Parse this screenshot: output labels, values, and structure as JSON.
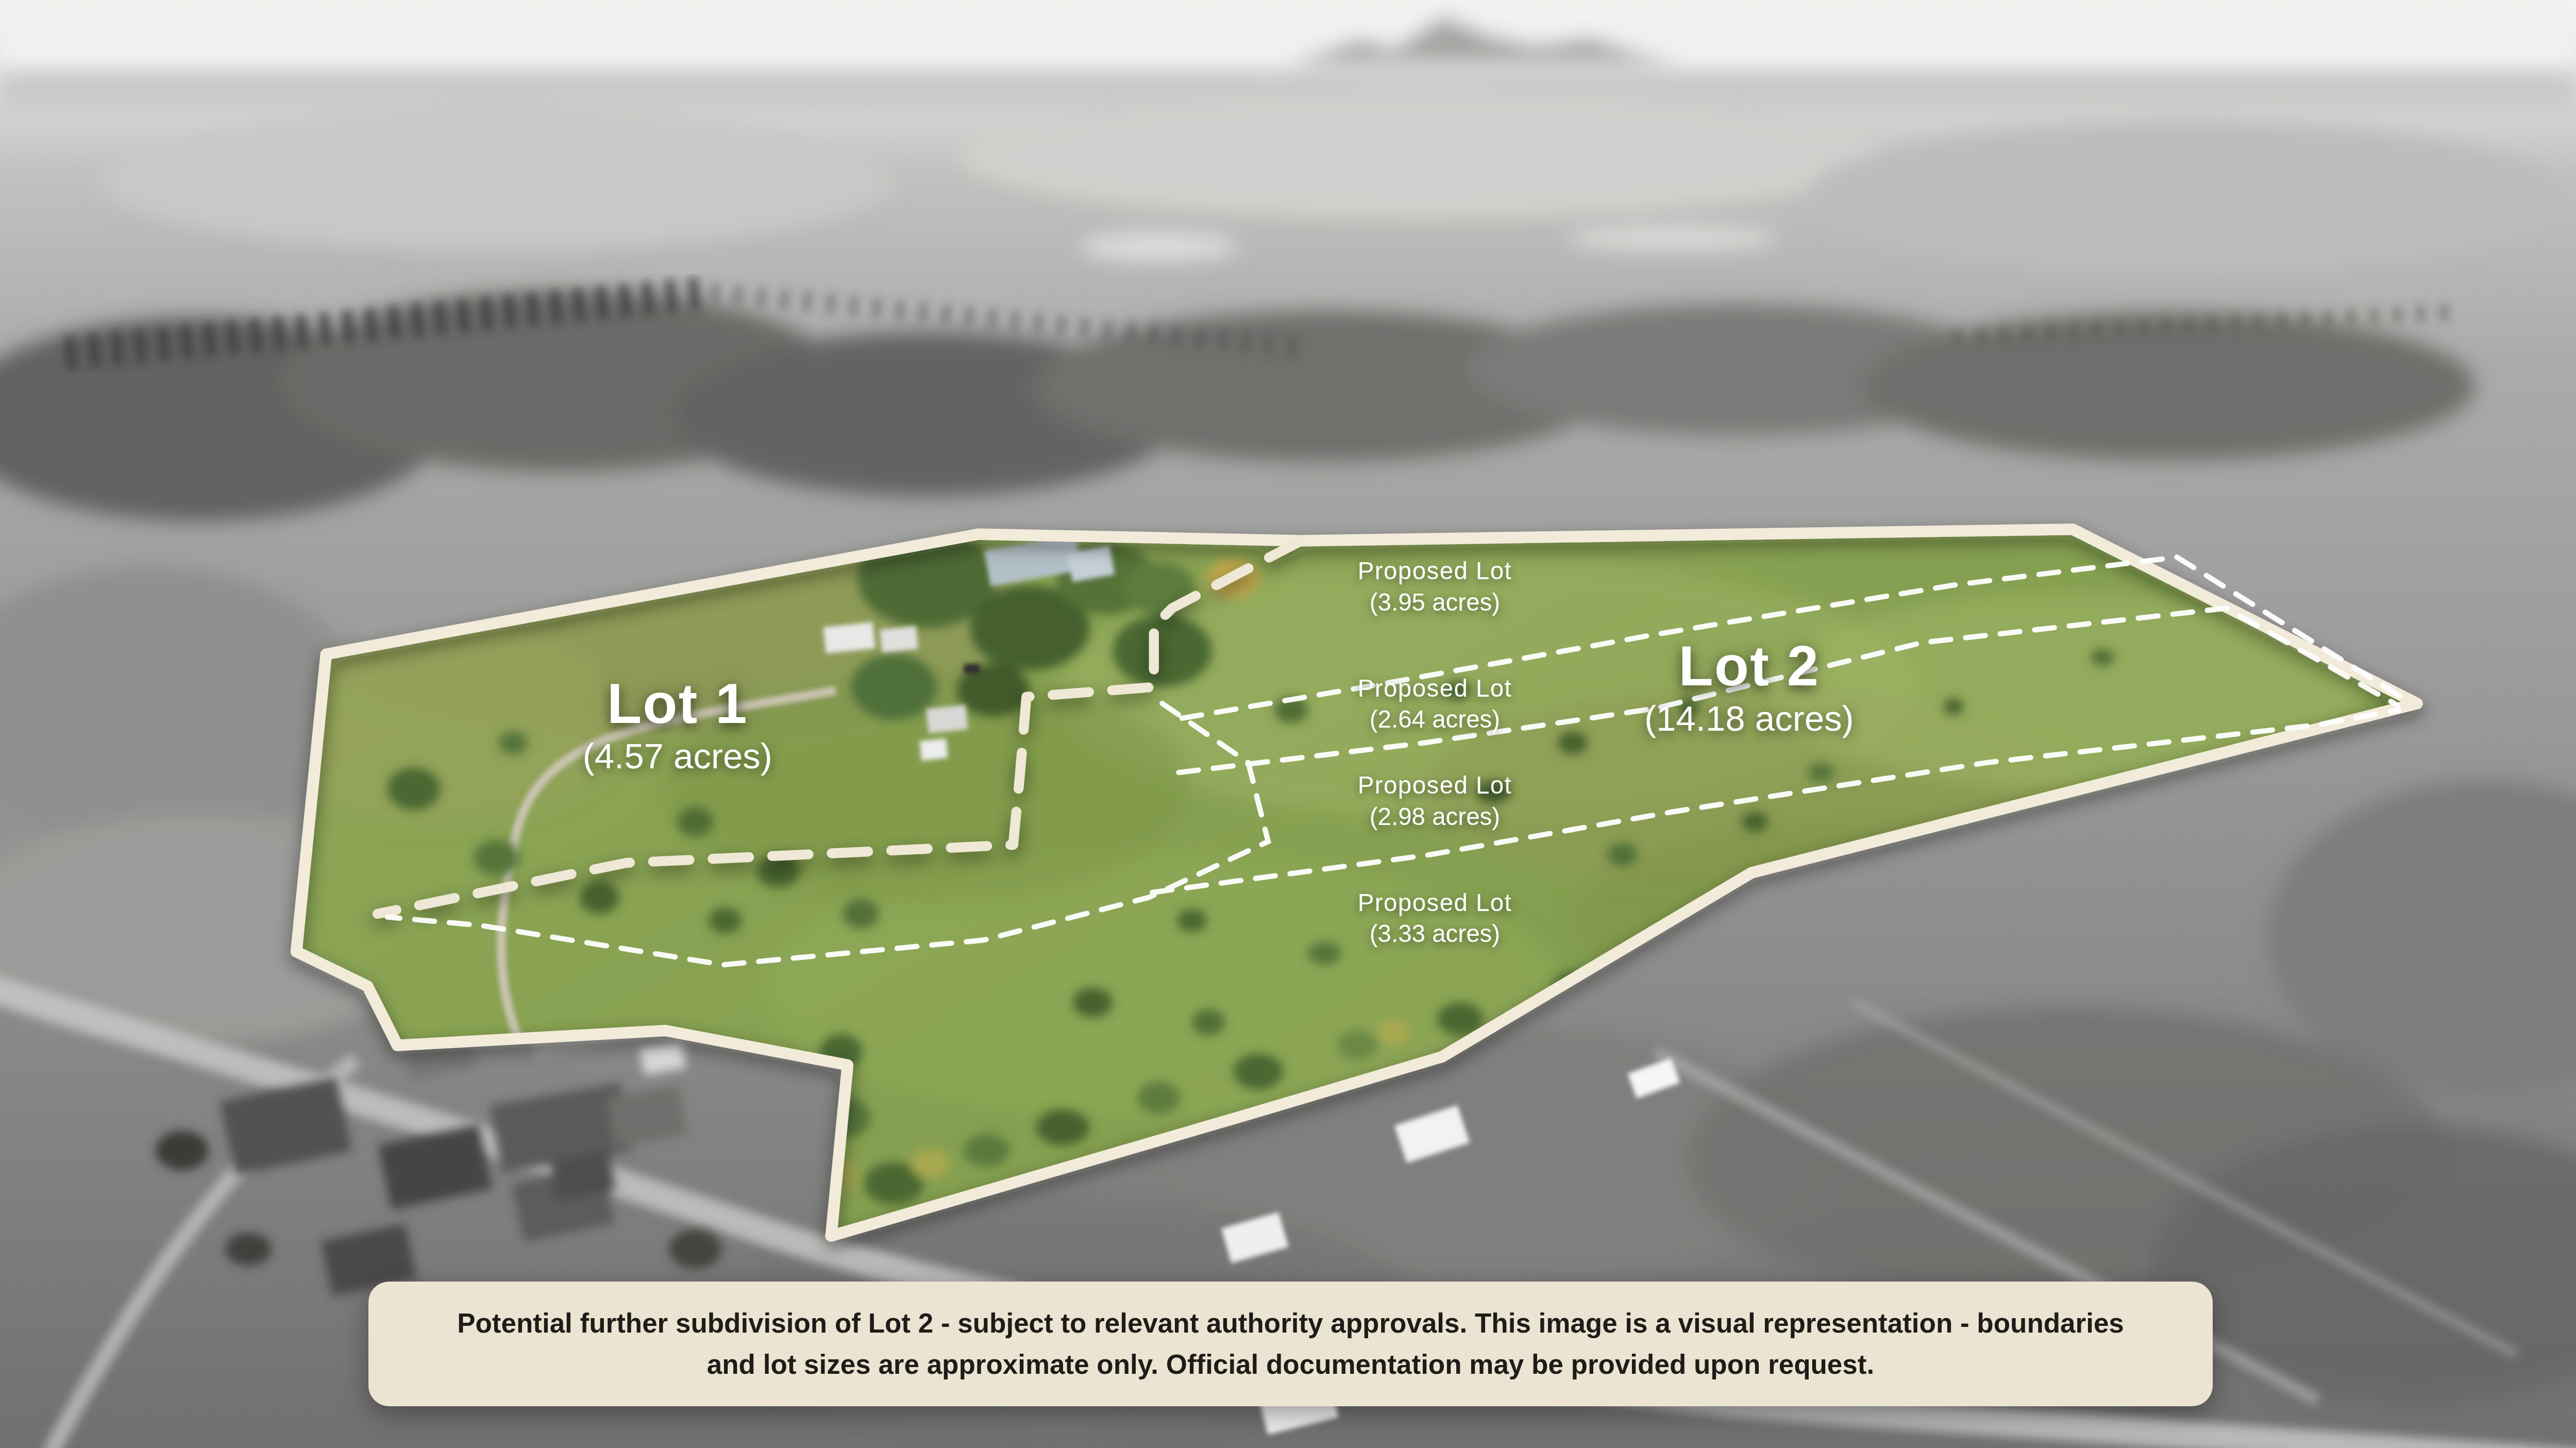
{
  "lots": {
    "lot1": {
      "name": "Lot 1",
      "size": "(4.57 acres)"
    },
    "lot2": {
      "name": "Lot 2",
      "size": "(14.18 acres)"
    }
  },
  "proposed_lots": [
    {
      "title": "Proposed Lot",
      "size": "(3.95 acres)"
    },
    {
      "title": "Proposed Lot",
      "size": "(2.64 acres)"
    },
    {
      "title": "Proposed Lot",
      "size": "(2.98 acres)"
    },
    {
      "title": "Proposed Lot",
      "size": "(3.33 acres)"
    }
  ],
  "disclaimer": {
    "text": "Potential further subdivision of Lot 2 - subject to relevant authority approvals. This image is a visual representation - boundaries and lot sizes are approximate only. Official documentation may be provided upon request."
  },
  "colors": {
    "boundary_cream": "#f2ebda",
    "divider_cream_dashed": "#efe8d6",
    "proposed_line_white": "#ffffff",
    "field_green": "#88a352",
    "label_white": "#ffffff",
    "disclaimer_background": "#ece4d2",
    "disclaimer_text": "#1e1c18"
  }
}
